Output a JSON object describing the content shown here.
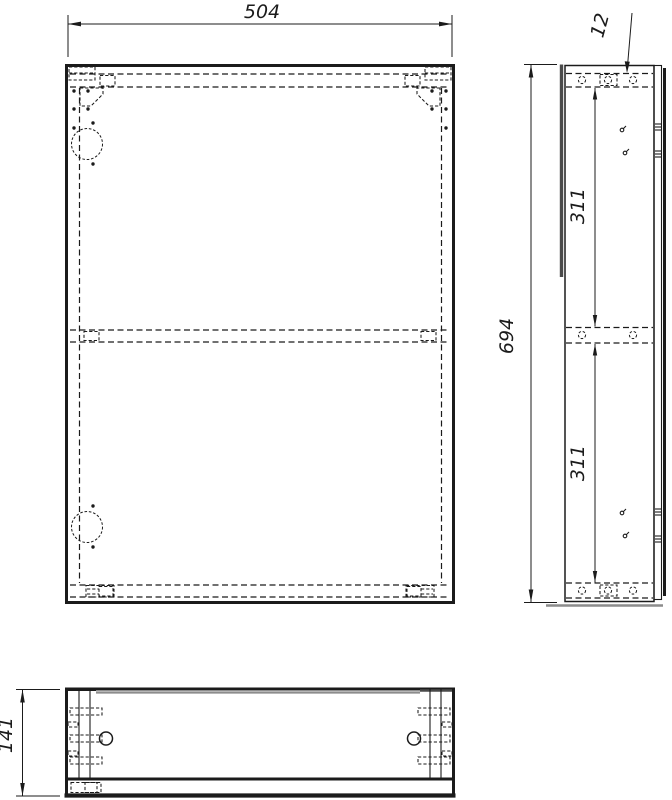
{
  "drawing": {
    "dimensions": {
      "overall_width": "504",
      "overall_height": "694",
      "top_panel_thickness": "12",
      "upper_shelf_spacing": "311",
      "lower_shelf_spacing": "311",
      "overall_depth": "141"
    },
    "colors": {
      "line": "#1b1b1b",
      "shadow": "#8c8c8c",
      "background": "#ffffff"
    }
  }
}
